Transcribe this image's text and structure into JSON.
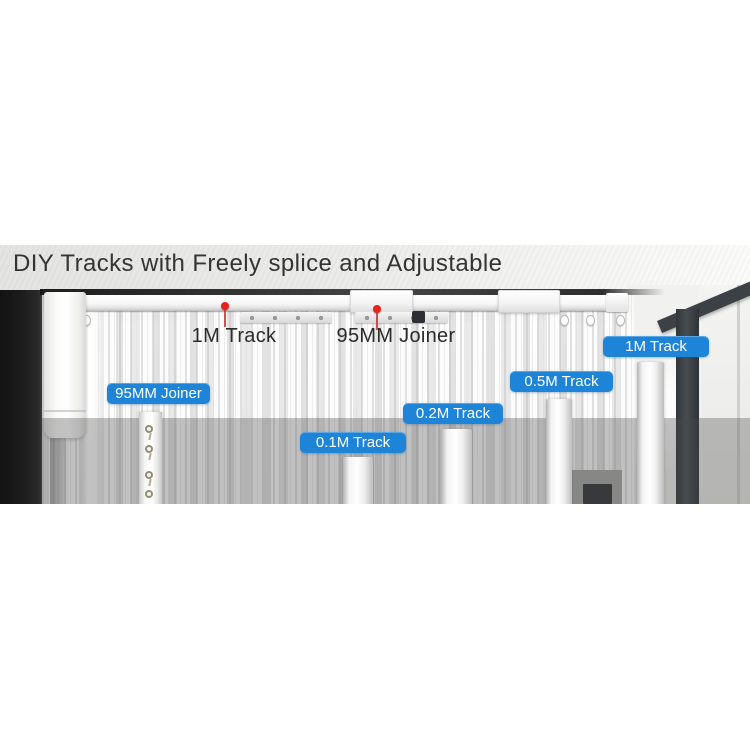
{
  "headline": {
    "text": "DIY Tracks with Freely splice and Adjustable"
  },
  "callouts": {
    "track_1m": {
      "label": "1M Track"
    },
    "joiner_95mm": {
      "label": "95MM Joiner"
    }
  },
  "badges": {
    "joiner_95mm": {
      "label": "95MM Joiner"
    },
    "track_0_1m": {
      "label": "0.1M Track"
    },
    "track_0_2m": {
      "label": "0.2M Track"
    },
    "track_0_5m": {
      "label": "0.5M Track"
    },
    "track_1m": {
      "label": "1M Track"
    }
  },
  "colors": {
    "badge_blue": "#1e84d8",
    "pin_red": "#e8231a",
    "headline_text": "#343434",
    "callout_text": "#2b2b2b",
    "window_frame": "#3c4146"
  }
}
